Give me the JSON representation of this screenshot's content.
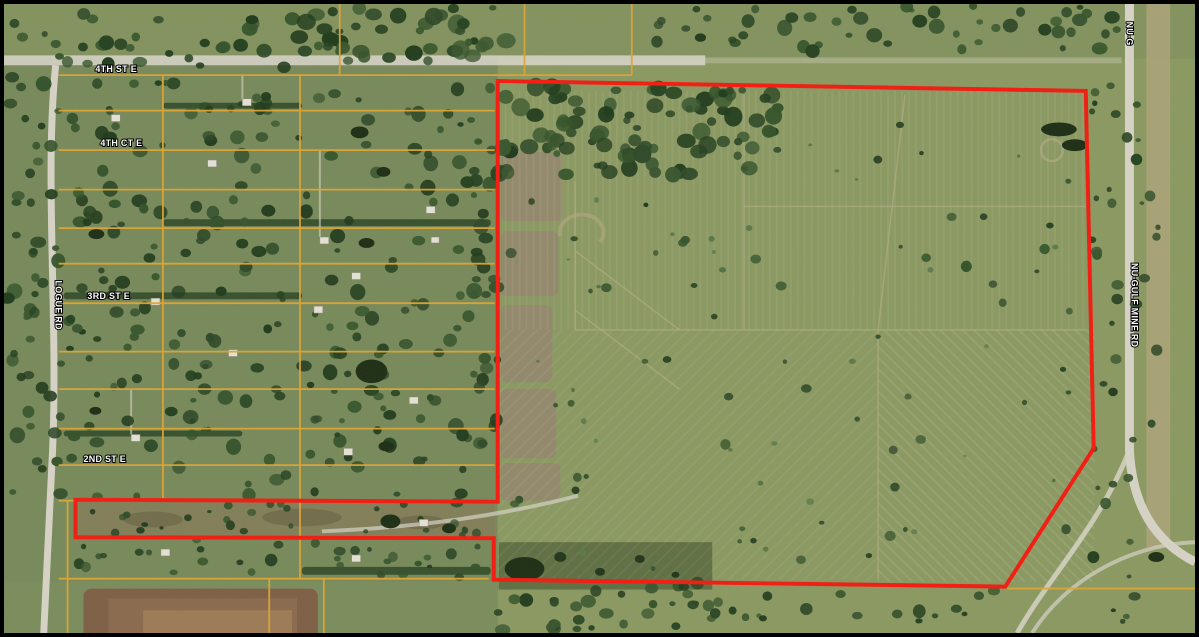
{
  "map": {
    "kind": "aerial-parcel-map"
  },
  "street_labels": {
    "fourth_st_e": "4TH ST E",
    "fourth_ct_e": "4TH CT E",
    "third_st_e": "3RD ST E",
    "second_st_e": "2ND ST E",
    "logue_rd": "LOGUE RD",
    "nu_gulf_mine_rd": "NU-GULF MINE RD",
    "nu_gulf_mine_rd_partial": "NU-G"
  },
  "boundary": {
    "color": "#f02015",
    "stroke_width": "4",
    "points": "497,78 1089,88 1097,450 1008,590 493,583 493,541 72,540 72,502 497,504"
  },
  "overlay_colors": {
    "parcel_lines": "#dda435",
    "frame": "#000000"
  },
  "imagery_colors": {
    "field_green": "#8a9861",
    "residential_green": "#77895a",
    "road_gray": "#d6d3c6",
    "marsh_tan": "#94846e",
    "dirt_pad_brown": "#7d5f45"
  }
}
